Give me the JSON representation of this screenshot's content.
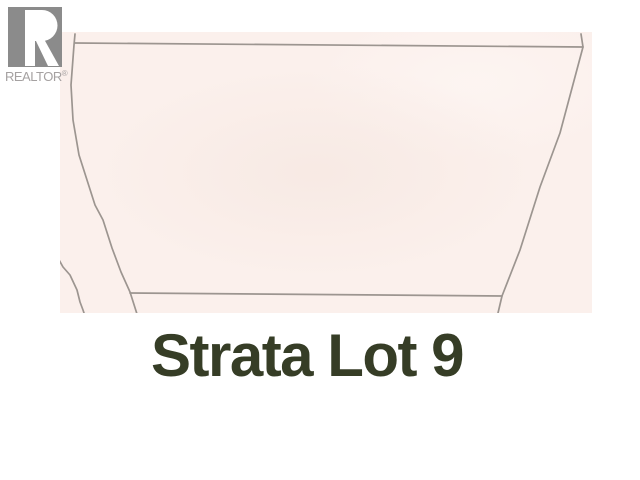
{
  "window": {
    "width": 640,
    "height": 480,
    "background_color": "#ffffff"
  },
  "branding": {
    "name": "REALTOR",
    "registered_mark": "®",
    "logo_icon": "realtor-block-r",
    "logo_color": "#8b8b8b",
    "logo_counter_color": "#ffffff",
    "wordmark_color": "#a5a1a1"
  },
  "title": {
    "text": "Strata Lot 9",
    "color": "#363d26"
  },
  "map": {
    "type": "parcel-map",
    "background_color": "#fbf0ec",
    "line_color": "#9c9590",
    "line_width": 1.7,
    "region": {
      "left": 60,
      "top": 32,
      "width": 532,
      "height": 281
    },
    "parcel_lines": {
      "top_boundary": [
        [
          15,
          11
        ],
        [
          523,
          15
        ]
      ],
      "right_boundary": [
        [
          521,
          2
        ],
        [
          523,
          15
        ],
        [
          500,
          101
        ],
        [
          480,
          155
        ],
        [
          460,
          218
        ],
        [
          442,
          264
        ],
        [
          438,
          281
        ]
      ],
      "left_boundary": [
        [
          15,
          2
        ],
        [
          14,
          13
        ],
        [
          11,
          53
        ],
        [
          13,
          88
        ],
        [
          19,
          123
        ],
        [
          27,
          148
        ],
        [
          35,
          173
        ],
        [
          43,
          188
        ],
        [
          52,
          216
        ],
        [
          61,
          240
        ],
        [
          70,
          260
        ],
        [
          77,
          282
        ]
      ],
      "bottom_boundary": [
        [
          70,
          261
        ],
        [
          442,
          264
        ]
      ],
      "adjacent_lot_boundary": [
        [
          -2,
          226
        ],
        [
          3,
          235
        ],
        [
          10,
          243
        ],
        [
          17,
          258
        ],
        [
          20,
          270
        ],
        [
          23,
          278
        ],
        [
          24,
          281
        ]
      ]
    }
  }
}
